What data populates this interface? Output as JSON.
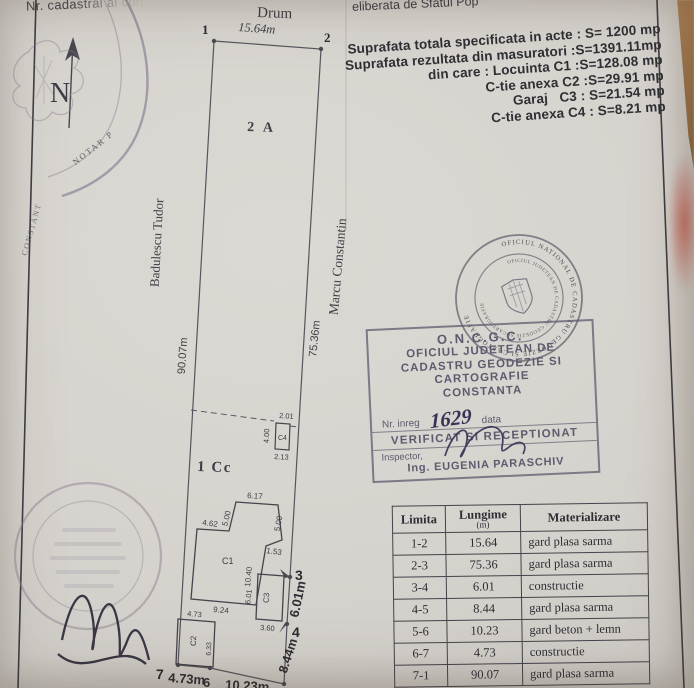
{
  "page": {
    "top_left_note": "Nr. cadastral al corp",
    "top_right_note": "eliberata de Sfatul Pop"
  },
  "areas": [
    "Suprafata totala specificata in acte : S= 1200 mp",
    "Suprafata rezultata din masuratori :S=1391.11mp",
    "din care : Locuinta C1 :S=128.08 mp",
    "C-tie anexa C2 :S=29.91 mp",
    "Garaj   C3 : S=21.54 mp",
    "C-tie anexa C4 : S=8.21 mp"
  ],
  "plan": {
    "north": "N",
    "road": "Drum",
    "top_dim": "15.64m",
    "parcel_labels": {
      "top": "2 A",
      "bottom": "1 Cc"
    },
    "neighbors": {
      "left": "Badulescu Tudor",
      "right": "Marcu Constantin"
    },
    "side_dims": {
      "left": "90.07m",
      "right": "75.36m"
    },
    "points": {
      "p1": "1",
      "p2": "2",
      "p3": "3",
      "p4": "4",
      "p6": "6",
      "p7": "7"
    },
    "edge_dims": {
      "right_upper": "6.01m",
      "right_lower": "8.44m",
      "bottom_left": "4.73m",
      "bottom_mid": "10.23m"
    },
    "c1": {
      "label": "C1",
      "top": "6.17",
      "left_upper": "5.00",
      "step": "4.62",
      "right_upper": "5.00",
      "notch": "1.53",
      "right_side": "10.40",
      "bottom": "9.24"
    },
    "c2": {
      "label": "C2",
      "top": "4.73",
      "side": "6.33"
    },
    "c3": {
      "label": "C3",
      "side": "6.01",
      "bottom": "3.60"
    },
    "c4": {
      "label": "C4",
      "top": "2.01",
      "side": "4.00",
      "bottom": "2.13"
    }
  },
  "stamps": {
    "round_outer": "OFICIUL NATIONAL DE CADASTRU GEODEZIE SI CARTOGRAFIE",
    "round_inner": "OFICIUL JUDETEAN DE CADASTRU GEODEZIE SI CARTOGRAFIE",
    "notary": {
      "a": "NOTAR P",
      "b": "CONSTANT"
    },
    "box": {
      "title": "O.N.C.G.C.",
      "line1": "OFICIUL JUDETEAN DE",
      "line2": "CADASTRU GEODEZIE SI",
      "line3": "CARTOGRAFIE",
      "line4": "CONSTANTA",
      "reg_label": "Nr. inreg",
      "reg_number": "1629",
      "date_label": "data",
      "verified": "VERIFICAT SI RECEPTIONAT",
      "inspector_label": "Inspector,",
      "inspector_name": "Ing. EUGENIA PARASCHIV"
    }
  },
  "table": {
    "headers": {
      "limita": "Limita",
      "lungime": "Lungime",
      "lungime_unit": "(m)",
      "materializare": "Materializare"
    },
    "rows": [
      [
        "1-2",
        "15.64",
        "gard plasa sarma"
      ],
      [
        "2-3",
        "75.36",
        "gard plasa sarma"
      ],
      [
        "3-4",
        "6.01",
        "constructie"
      ],
      [
        "4-5",
        "8.44",
        "gard plasa sarma"
      ],
      [
        "5-6",
        "10.23",
        "gard beton + lemn"
      ],
      [
        "6-7",
        "4.73",
        "constructie"
      ],
      [
        "7-1",
        "90.07",
        "gard plasa sarma"
      ]
    ]
  },
  "colors": {
    "paper": "#d6d2cd",
    "ink": "#46444b",
    "stamp": "#6f6b78",
    "signature": "#35304a",
    "table_wood": "#a5794f"
  }
}
